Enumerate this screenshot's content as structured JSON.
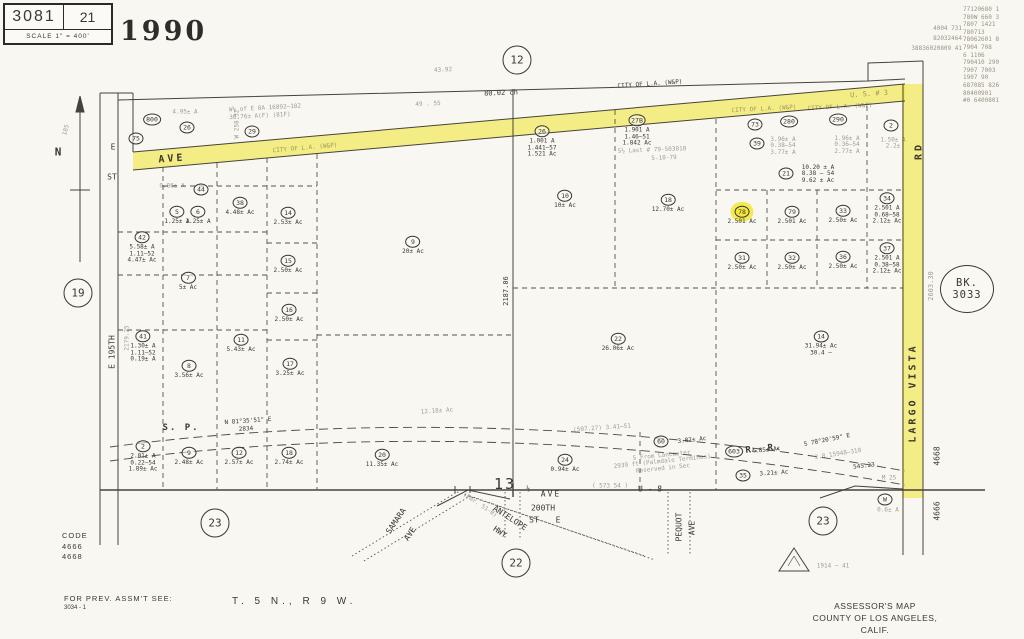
{
  "header": {
    "book": "3081",
    "page": "21",
    "scale_label": "SCALE 1\" = 400'",
    "year": "1990"
  },
  "revisions": {
    "left": [
      "4004 731",
      "82032464",
      "38836020809 41"
    ],
    "right": [
      "77120680 1",
      "780W 660 3",
      "7807 1421",
      "780713",
      "78062601 8",
      "7904 708",
      "6 1106",
      "790410 290",
      "7907 7003",
      "1907 90",
      "687085 826",
      "80400901",
      "#0 6400801"
    ]
  },
  "map": {
    "book_stamp": {
      "line1": "BK.",
      "line2": "3033"
    },
    "section_markers": [
      {
        "label": "12",
        "x": 517,
        "y": 60
      },
      {
        "label": "19",
        "x": 78,
        "y": 293
      },
      {
        "label": "23",
        "x": 215,
        "y": 523
      },
      {
        "label": "22",
        "x": 516,
        "y": 563
      },
      {
        "label": "23",
        "x": 823,
        "y": 521
      }
    ],
    "parcels": [
      {
        "id": "800",
        "x": 152,
        "y": 116
      },
      {
        "id": "75",
        "x": 136,
        "y": 135
      },
      {
        "id": "26",
        "x": 187,
        "y": 124
      },
      {
        "id": "29",
        "x": 252,
        "y": 128
      },
      {
        "id": "26",
        "x": 542,
        "y": 138,
        "lines": [
          "1.001 A",
          "1.441—57",
          "1.521 Ac"
        ]
      },
      {
        "id": "27B",
        "x": 637,
        "y": 127,
        "lines": [
          "1.901 A",
          "1.46—51",
          "1.842 Ac"
        ]
      },
      {
        "id": "73",
        "x": 755,
        "y": 121
      },
      {
        "id": "280",
        "x": 789,
        "y": 118
      },
      {
        "id": "290",
        "x": 838,
        "y": 116
      },
      {
        "id": "2",
        "x": 891,
        "y": 122
      },
      {
        "id": "39",
        "x": 757,
        "y": 140
      },
      {
        "id": "21",
        "x": 786,
        "y": 170
      },
      {
        "id": "18",
        "x": 668,
        "y": 200,
        "lines": [
          "12.70± Ac"
        ]
      },
      {
        "id": "10",
        "x": 565,
        "y": 196,
        "lines": [
          "10± Ac"
        ]
      },
      {
        "id": "9",
        "x": 413,
        "y": 242,
        "lines": [
          "20± Ac"
        ]
      },
      {
        "id": "44",
        "x": 201,
        "y": 186
      },
      {
        "id": "5",
        "x": 177,
        "y": 212,
        "lines": [
          "1.25± A"
        ]
      },
      {
        "id": "6",
        "x": 198,
        "y": 212,
        "lines": [
          "1.25± A"
        ]
      },
      {
        "id": "38",
        "x": 240,
        "y": 203,
        "lines": [
          "4.48± Ac"
        ]
      },
      {
        "id": "14",
        "x": 288,
        "y": 213,
        "lines": [
          "2.53± Ac"
        ]
      },
      {
        "id": "42",
        "x": 142,
        "y": 244,
        "lines": [
          "5.58± A",
          "1.11—52",
          "4.47± Ac"
        ]
      },
      {
        "id": "15",
        "x": 288,
        "y": 261,
        "lines": [
          "2.50± Ac"
        ]
      },
      {
        "id": "7",
        "x": 188,
        "y": 278,
        "lines": [
          "5± Ac"
        ]
      },
      {
        "id": "16",
        "x": 289,
        "y": 310,
        "lines": [
          "2.50± Ac"
        ]
      },
      {
        "id": "41",
        "x": 143,
        "y": 343,
        "lines": [
          "1.30± A",
          "1.11—52",
          "0.19± A"
        ]
      },
      {
        "id": "11",
        "x": 241,
        "y": 340,
        "lines": [
          "5.43± Ac"
        ]
      },
      {
        "id": "8",
        "x": 189,
        "y": 366,
        "lines": [
          "3.56± Ac"
        ]
      },
      {
        "id": "17",
        "x": 290,
        "y": 364,
        "lines": [
          "3.25± Ac"
        ]
      },
      {
        "id": "78",
        "x": 742,
        "y": 212,
        "lines": [
          "2.501 Ac"
        ],
        "hl": true
      },
      {
        "id": "79",
        "x": 792,
        "y": 212,
        "lines": [
          "2.501 Ac"
        ]
      },
      {
        "id": "33",
        "x": 843,
        "y": 211,
        "lines": [
          "2.50± Ac"
        ]
      },
      {
        "id": "34",
        "x": 887,
        "y": 205,
        "lines": [
          "2.501 A",
          "0.68—58",
          "2.12± Ac"
        ]
      },
      {
        "id": "31",
        "x": 742,
        "y": 258,
        "lines": [
          "2.50± Ac"
        ]
      },
      {
        "id": "32",
        "x": 792,
        "y": 258,
        "lines": [
          "2.50± Ac"
        ]
      },
      {
        "id": "36",
        "x": 843,
        "y": 257,
        "lines": [
          "2.50± Ac"
        ]
      },
      {
        "id": "37",
        "x": 887,
        "y": 255,
        "lines": [
          "2.501 A",
          "0.38—58",
          "2.12± Ac"
        ]
      },
      {
        "id": "22",
        "x": 618,
        "y": 339,
        "lines": [
          "26.06± Ac"
        ]
      },
      {
        "id": "14",
        "x": 821,
        "y": 340,
        "lines": [
          "31.94± Ac",
          "30.4 —"
        ]
      },
      {
        "id": "2",
        "x": 143,
        "y": 453,
        "lines": [
          "2.01± A",
          "0.22—54",
          "1.89± Ac"
        ]
      },
      {
        "id": "9",
        "x": 189,
        "y": 453,
        "lines": [
          "2.48± Ac"
        ]
      },
      {
        "id": "12",
        "x": 239,
        "y": 453,
        "lines": [
          "2.57± Ac"
        ]
      },
      {
        "id": "18",
        "x": 289,
        "y": 453,
        "lines": [
          "2.74± Ac"
        ]
      },
      {
        "id": "20",
        "x": 382,
        "y": 455,
        "lines": [
          "11.35± Ac"
        ]
      },
      {
        "id": "24",
        "x": 565,
        "y": 460,
        "lines": [
          "0.94± Ac"
        ]
      },
      {
        "id": "60",
        "x": 661,
        "y": 438
      },
      {
        "id": "603",
        "x": 734,
        "y": 448
      },
      {
        "id": "35",
        "x": 743,
        "y": 472
      },
      {
        "id": "W",
        "x": 885,
        "y": 496
      }
    ],
    "labels": [
      {
        "text": "80.02 ch",
        "x": 501,
        "y": 93,
        "rot": -2,
        "cls": "t7"
      },
      {
        "text": "43.92",
        "x": 443,
        "y": 70,
        "rot": -2,
        "cls": "t6 faint"
      },
      {
        "text": "49 . 55",
        "x": 428,
        "y": 104,
        "rot": -2,
        "cls": "t6 faint"
      },
      {
        "text": "W½ of E 8A 16892—102",
        "x": 265,
        "y": 108,
        "rot": -3,
        "cls": "t6 faint"
      },
      {
        "text": "30.76± A(F) (81F)",
        "x": 260,
        "y": 116,
        "rot": -3,
        "cls": "t6 faint"
      },
      {
        "text": "4.95± A",
        "x": 185,
        "y": 112,
        "cls": "t6 faint"
      },
      {
        "text": "CITY OF L.A. (W&P)",
        "x": 650,
        "y": 84,
        "rot": -4,
        "cls": "t6"
      },
      {
        "text": "CITY OF L.A. (W&P)",
        "x": 764,
        "y": 109,
        "rot": -3,
        "cls": "t6 faint"
      },
      {
        "text": "CITY OF L.A. (W&P)",
        "x": 840,
        "y": 107,
        "rot": -3,
        "cls": "t6 faint"
      },
      {
        "text": "CITY OF L.A. (W&P)",
        "x": 305,
        "y": 148,
        "rot": -5,
        "cls": "t6 faint"
      },
      {
        "text": "S½ Last # 79-503010",
        "x": 652,
        "y": 150,
        "rot": -2,
        "cls": "t6 faint"
      },
      {
        "text": "5-10-79",
        "x": 664,
        "y": 158,
        "rot": -2,
        "cls": "t6 faint"
      },
      {
        "text": "U. S. # 3",
        "x": 869,
        "y": 94,
        "rot": -4,
        "cls": "t7 faint"
      },
      {
        "text": "AVE",
        "x": 172,
        "y": 159,
        "rot": -4,
        "cls": "road"
      },
      {
        "text": "RD",
        "x": 919,
        "y": 151,
        "rot": -90,
        "cls": "road"
      },
      {
        "text": "LARGO   VISTA",
        "x": 913,
        "y": 393,
        "rot": -90,
        "cls": "road"
      },
      {
        "text": "E",
        "x": 113,
        "y": 147,
        "cls": "t8"
      },
      {
        "text": "ST",
        "x": 112,
        "y": 177,
        "cls": "t8"
      },
      {
        "text": "E 195TH",
        "x": 112,
        "y": 352,
        "rot": -90,
        "cls": "t8"
      },
      {
        "text": "2179.25",
        "x": 127,
        "y": 338,
        "rot": -90,
        "cls": "t6 faint"
      },
      {
        "text": "N",
        "x": 58,
        "y": 152,
        "cls": "t10"
      },
      {
        "text": "185",
        "x": 66,
        "y": 130,
        "rot": -75,
        "cls": "t6 faint"
      },
      {
        "text": "W 258.32",
        "x": 237,
        "y": 124,
        "rot": -90,
        "cls": "t6 faint"
      },
      {
        "text": "2187.06",
        "x": 506,
        "y": 291,
        "rot": -90,
        "cls": "t7"
      },
      {
        "text": "2603.30",
        "x": 931,
        "y": 286,
        "rot": -90,
        "cls": "t7 faint"
      },
      {
        "text": "S. P.",
        "x": 181,
        "y": 428,
        "cls": "road sp"
      },
      {
        "text": "R. R.",
        "x": 764,
        "y": 449,
        "rot": -6,
        "cls": "road sp"
      },
      {
        "text": "N 81°35'51\" E",
        "x": 248,
        "y": 421,
        "rot": -4,
        "cls": "t6"
      },
      {
        "text": "2834",
        "x": 246,
        "y": 429,
        "rot": -4,
        "cls": "t6"
      },
      {
        "text": "(507.27)    3.41—51",
        "x": 602,
        "y": 428,
        "rot": -4,
        "cls": "t6 faint"
      },
      {
        "text": "12.18± Ac",
        "x": 437,
        "y": 411,
        "rot": -4,
        "cls": "t6 faint"
      },
      {
        "text": "S 78°20'59\" E",
        "x": 827,
        "y": 440,
        "rot": -11,
        "cls": "t6"
      },
      {
        "text": "2.8  15948—310",
        "x": 838,
        "y": 454,
        "rot": -9,
        "cls": "t6 faint"
      },
      {
        "text": "545.23",
        "x": 864,
        "y": 466,
        "rot": -7,
        "cls": "t6"
      },
      {
        "text": "M 25",
        "x": 889,
        "y": 478,
        "cls": "t6 faint"
      },
      {
        "text": "13",
        "x": 505,
        "y": 484,
        "cls": "big13"
      },
      {
        "text": "½",
        "x": 528,
        "y": 489,
        "cls": "t6"
      },
      {
        "text": "AVE",
        "x": 551,
        "y": 494,
        "cls": "t8 ls"
      },
      {
        "text": "( 573 54 )",
        "x": 610,
        "y": 486,
        "cls": "t6 faint"
      },
      {
        "text": "U - 8",
        "x": 650,
        "y": 489,
        "cls": "t8"
      },
      {
        "text": "200TH",
        "x": 543,
        "y": 508,
        "cls": "t8"
      },
      {
        "text": "ST",
        "x": 534,
        "y": 520,
        "cls": "t8"
      },
      {
        "text": "E",
        "x": 558,
        "y": 520,
        "cls": "t8"
      },
      {
        "text": "SAMARA",
        "x": 396,
        "y": 521,
        "rot": -56,
        "cls": "t8"
      },
      {
        "text": "AVE",
        "x": 410,
        "y": 534,
        "rot": -56,
        "cls": "t8"
      },
      {
        "text": "(Fmr. 51-B)",
        "x": 480,
        "y": 505,
        "rot": 33,
        "cls": "t6 faint"
      },
      {
        "text": "ANTELOPE",
        "x": 510,
        "y": 518,
        "rot": 33,
        "cls": "t8"
      },
      {
        "text": "HWY",
        "x": 500,
        "y": 532,
        "rot": 33,
        "cls": "t8"
      },
      {
        "text": "PEQUOT",
        "x": 679,
        "y": 527,
        "rot": -90,
        "cls": "t8"
      },
      {
        "text": "AVE",
        "x": 692,
        "y": 528,
        "rot": -90,
        "cls": "t8"
      },
      {
        "text": "4668",
        "x": 937,
        "y": 456,
        "rot": -90,
        "cls": "t8"
      },
      {
        "text": "4666",
        "x": 937,
        "y": 511,
        "rot": -90,
        "cls": "t8"
      },
      {
        "text": "10.20 ± A\n8.38 — 54\n9.62 ± Ac",
        "x": 818,
        "y": 171,
        "cls": "t6 pre"
      },
      {
        "text": "3.96± A\n0.38—54\n3.77± A",
        "x": 783,
        "y": 143,
        "cls": "t6 faint pre"
      },
      {
        "text": "1.96± A\n0.36—54\n2.77± A",
        "x": 847,
        "y": 142,
        "cls": "t6 faint pre"
      },
      {
        "text": "1.50± A\n2.2±",
        "x": 893,
        "y": 140,
        "cls": "t6 faint pre"
      },
      {
        "text": "0.86± A",
        "x": 172,
        "y": 186,
        "cls": "t6 faint"
      },
      {
        "text": "4.85± Ac",
        "x": 766,
        "y": 450,
        "rot": -6,
        "cls": "t6"
      },
      {
        "text": "3.82± Ac",
        "x": 692,
        "y": 440,
        "rot": -6,
        "cls": "t6"
      },
      {
        "text": "3.21± Ac",
        "x": 774,
        "y": 473,
        "rot": -4,
        "cls": "t6"
      },
      {
        "text": "0.6± A",
        "x": 888,
        "y": 510,
        "cls": "t6 faint"
      },
      {
        "text": "5 From Lancaster\n2939 ft (Palmdale Terminus)\nReserved in Sec",
        "x": 662,
        "y": 459,
        "rot": -6,
        "cls": "t6 faint pre"
      },
      {
        "text": "1914 — 41",
        "x": 833,
        "y": 566,
        "cls": "t6 faint"
      }
    ]
  },
  "footer": {
    "code_title": "CODE",
    "code_lines": [
      "4666",
      "4668"
    ],
    "prev_label": "FOR PREV. ASSM'T SEE:",
    "prev_number": "3034 - 1",
    "township": "T. 5 N.,  R 9 W.",
    "assessor_line1": "ASSESSOR'S MAP",
    "assessor_line2": "COUNTY OF LOS ANGELES, CALIF."
  },
  "colors": {
    "highlight_yellow": "#f2e73a",
    "ink": "#3a3831",
    "faded_note": "#9b9481"
  }
}
